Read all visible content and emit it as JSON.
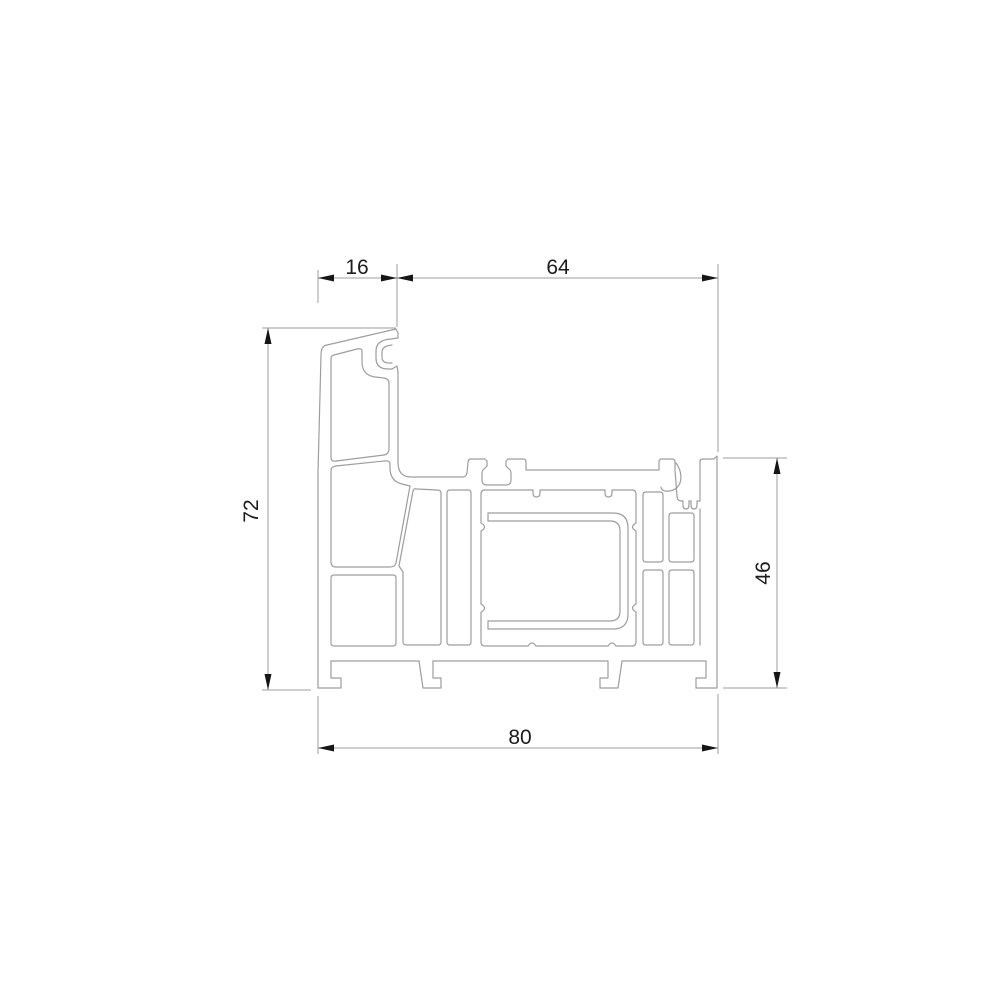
{
  "canvas": {
    "background": "#ffffff"
  },
  "drawing": {
    "kind": "window-profile-cross-section",
    "stroke_color": "#9d9d9d",
    "annotation_color": "#161616",
    "dimensions": {
      "upstand_width": "16",
      "body_width": "64",
      "total_height": "72",
      "body_height": "46",
      "total_width": "80"
    }
  }
}
